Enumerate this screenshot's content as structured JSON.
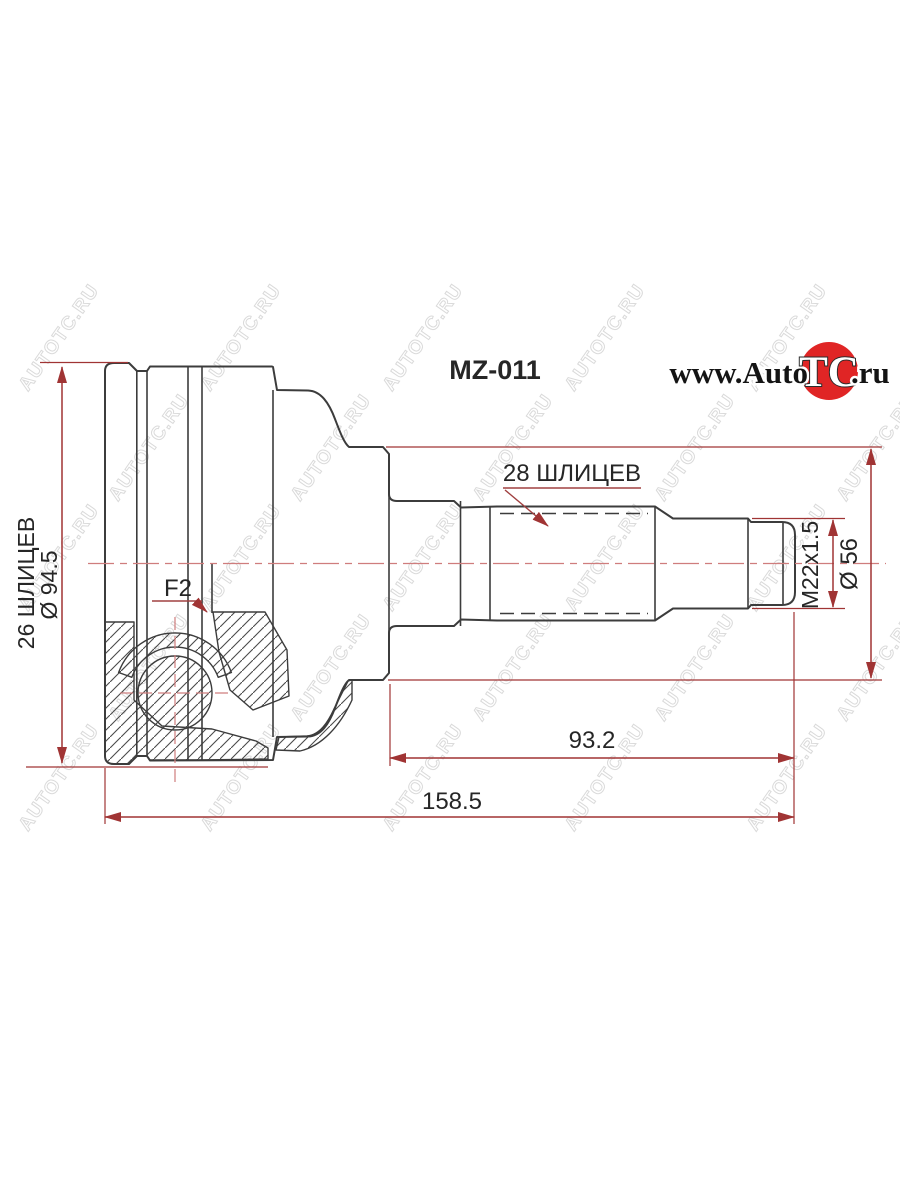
{
  "logo": {
    "prefix": "www.Auto",
    "tc": "TC",
    "domain": ".ru",
    "circle_color": "#e02525"
  },
  "watermark": {
    "text": "AUTOTC.RU",
    "color": "#dadada"
  },
  "drawing": {
    "part_code": "MZ-011",
    "shaft_splines_label": "28 ШЛИЦЕВ",
    "inner_splines_label": "26 ШЛИЦЕВ",
    "outer_diameter_label": "Ø 94.5",
    "groove_label": "F2",
    "thread_label": "M22x1.5",
    "shaft_diameter_label": "Ø 56",
    "spline_section_length_label": "93.2",
    "overall_length_label": "158.5",
    "dimension_color": "#a03434",
    "line_color": "#3c3c3c"
  }
}
